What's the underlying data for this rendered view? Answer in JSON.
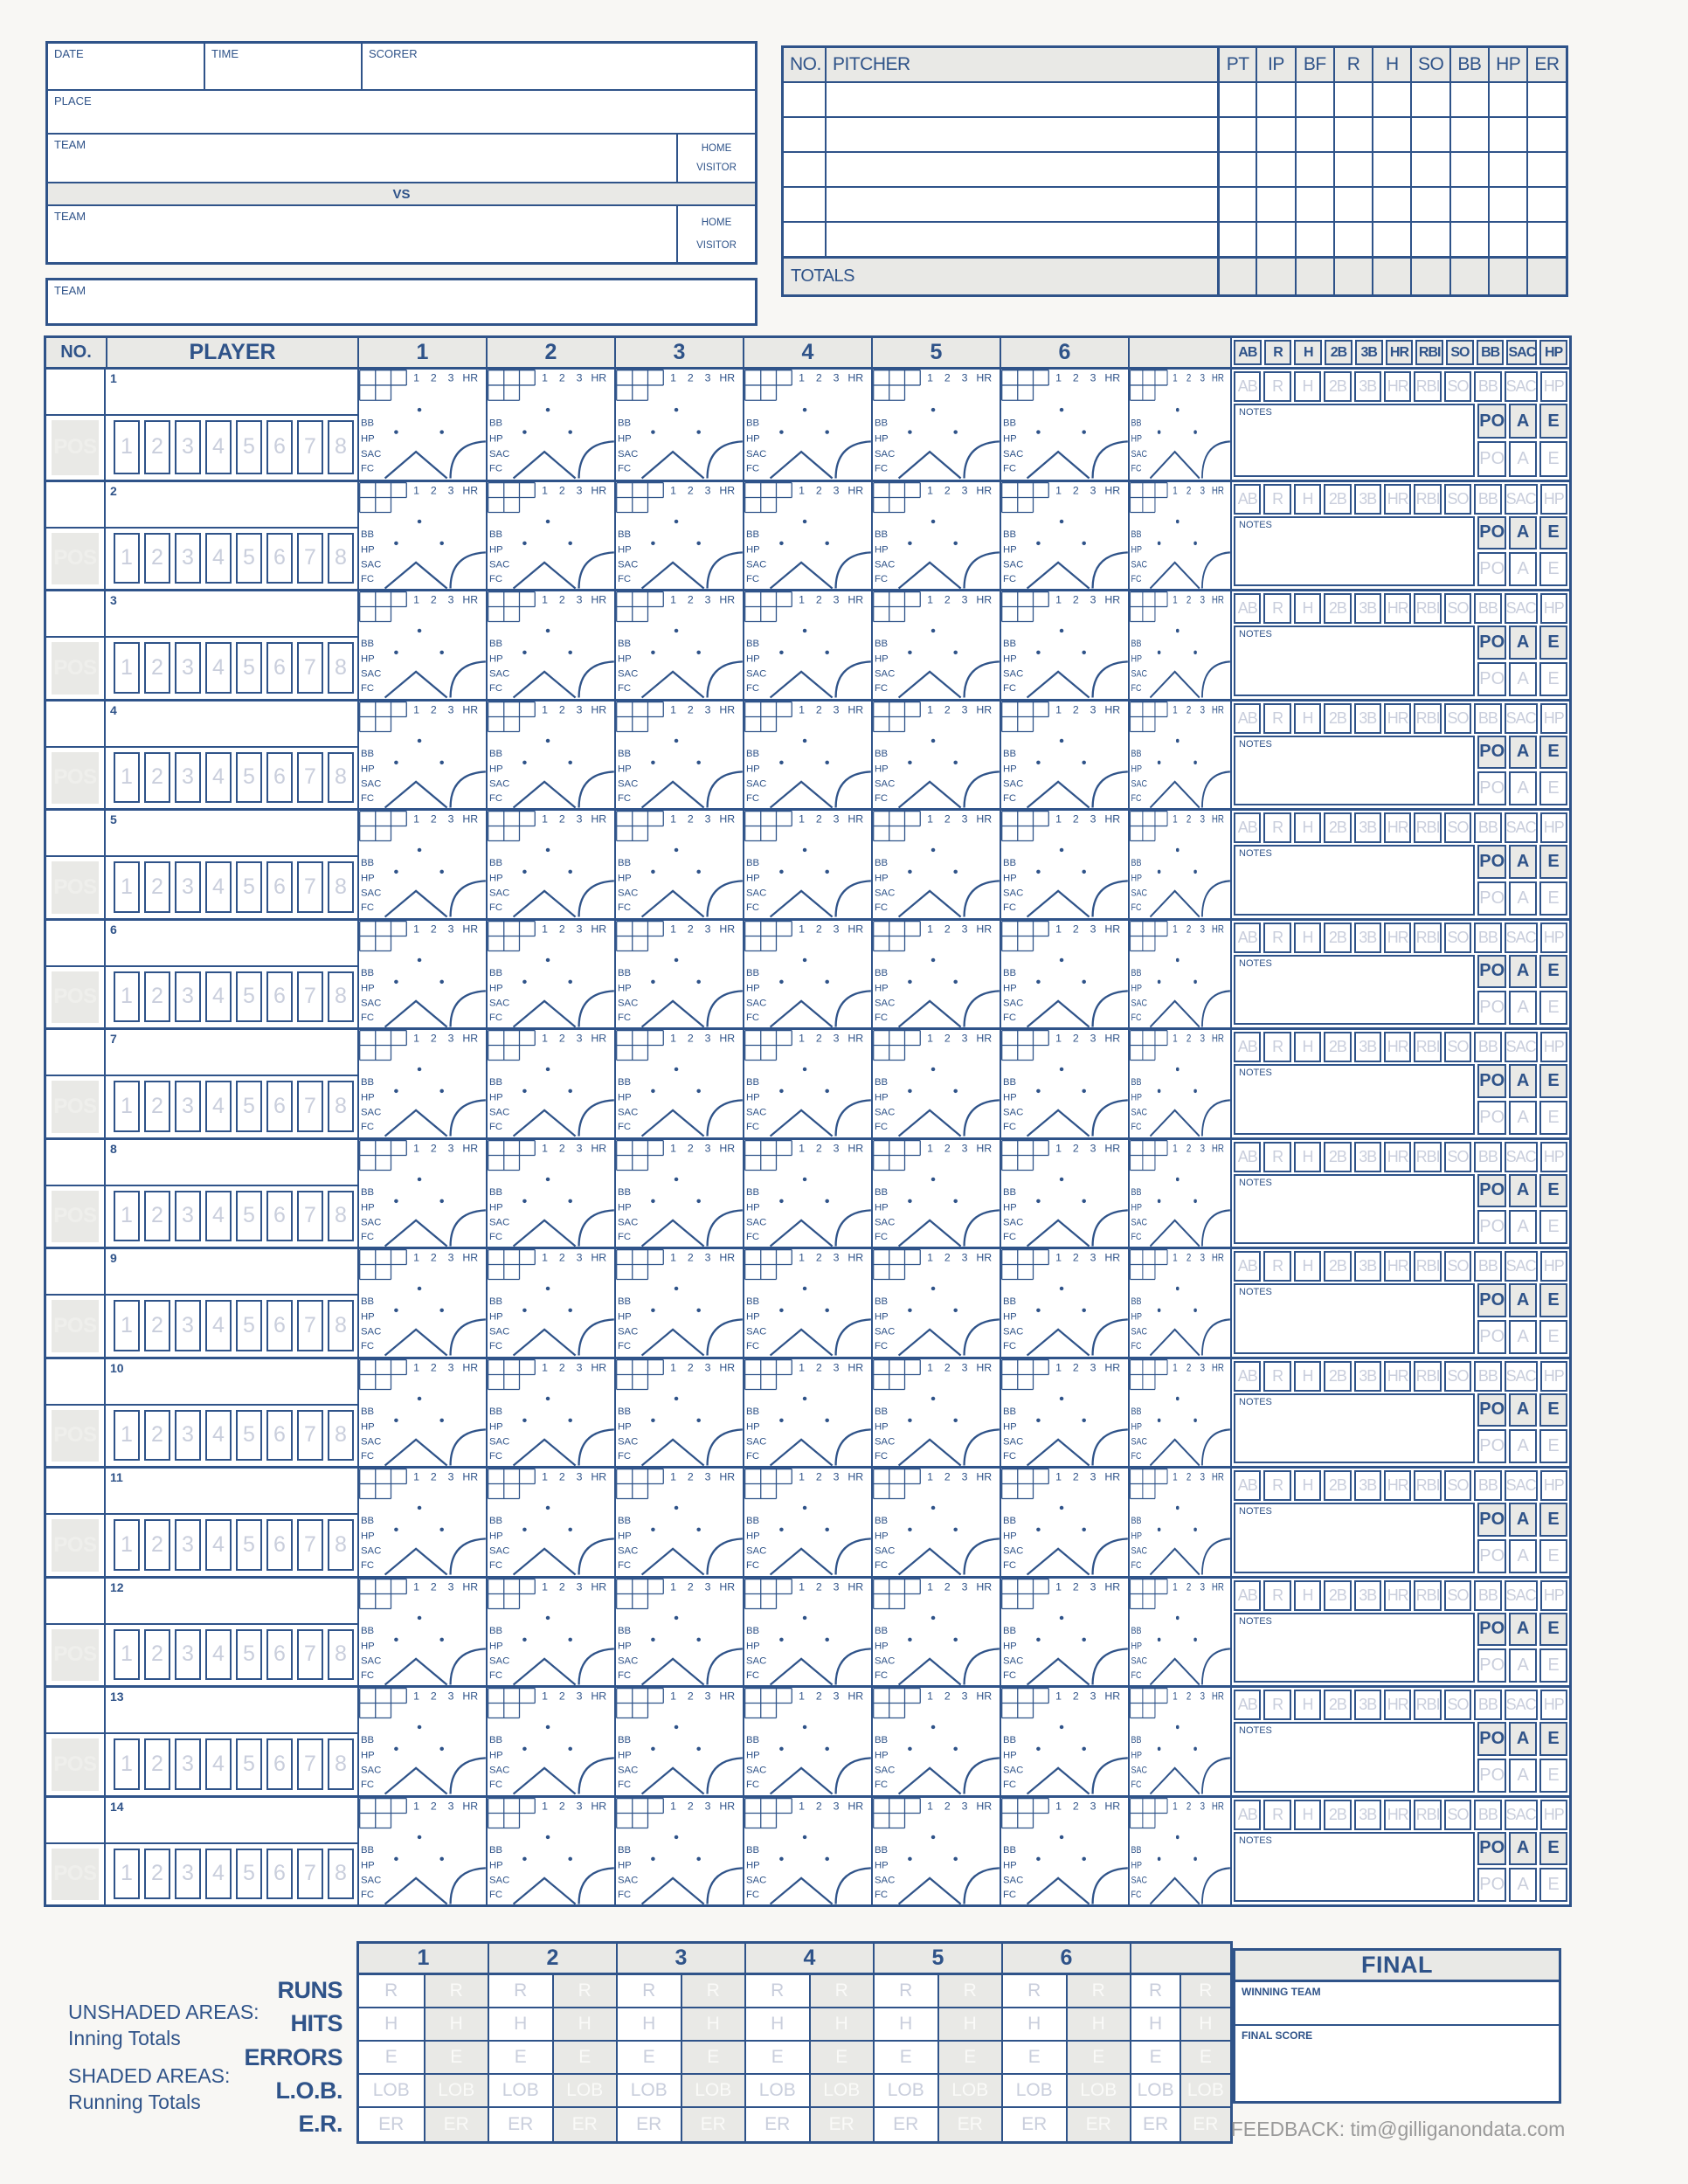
{
  "colors": {
    "navy": "#2F5389",
    "panel_gray": "#E9E9E6",
    "ghost_blue": "#C9CEDC",
    "ghost_white": "#FAFAF8",
    "page_bg": "#F8F7F4",
    "feedback_gray": "#9A9A9A"
  },
  "game_info": {
    "date_label": "DATE",
    "time_label": "TIME",
    "scorer_label": "SCORER",
    "place_label": "PLACE",
    "team_label_top": "TEAM",
    "team_label_bottom": "TEAM",
    "home_label": "HOME",
    "visitor_label": "VISITOR",
    "vs_label": "VS"
  },
  "team_box": {
    "team_label": "TEAM"
  },
  "pitchers": {
    "headers": [
      "NO.",
      "PITCHER",
      "PT",
      "IP",
      "BF",
      "R",
      "H",
      "SO",
      "BB",
      "HP",
      "ER"
    ],
    "empty_row_count": 5,
    "totals_label": "TOTALS"
  },
  "batting": {
    "no_header": "NO.",
    "player_header": "PLAYER",
    "inning_headers": [
      "1",
      "2",
      "3",
      "4",
      "5",
      "6",
      ""
    ],
    "stat_headers": [
      "AB",
      "R",
      "H",
      "2B",
      "3B",
      "HR",
      "RBI",
      "SO",
      "BB",
      "SAC",
      "HP"
    ],
    "players": [
      {
        "order": "1"
      },
      {
        "order": "2"
      },
      {
        "order": "3"
      },
      {
        "order": "4"
      },
      {
        "order": "5"
      },
      {
        "order": "6"
      },
      {
        "order": "7"
      },
      {
        "order": "8"
      },
      {
        "order": "9"
      },
      {
        "order": "10"
      },
      {
        "order": "11"
      },
      {
        "order": "12"
      },
      {
        "order": "13"
      },
      {
        "order": "14"
      }
    ],
    "pos_label": "POS",
    "position_numbers": [
      "1",
      "2",
      "3",
      "4",
      "5",
      "6",
      "7",
      "8"
    ],
    "inning_cell": {
      "base_hit_labels": [
        "1",
        "2",
        "3",
        "HR"
      ],
      "reach_labels": [
        "BB",
        "HP",
        "SAC",
        "FC"
      ]
    },
    "notes_label": "NOTES",
    "fielding_labels": [
      "PO",
      "A",
      "E"
    ]
  },
  "bottom_totals": {
    "legend": [
      {
        "title": "UNSHADED AREAS:",
        "subtitle": "Inning Totals"
      },
      {
        "title": "SHADED AREAS:",
        "subtitle": "Running Totals"
      }
    ],
    "row_labels": [
      "RUNS",
      "HITS",
      "ERRORS",
      "L.O.B.",
      "E.R."
    ],
    "cell_letters": [
      "R",
      "H",
      "E",
      "LOB",
      "ER"
    ],
    "inning_headers": [
      "1",
      "2",
      "3",
      "4",
      "5",
      "6",
      ""
    ]
  },
  "final_box": {
    "title": "FINAL",
    "winning_team_label": "WINNING TEAM",
    "final_score_label": "FINAL SCORE"
  },
  "feedback_text": "FEEDBACK: tim@gilliganondata.com"
}
